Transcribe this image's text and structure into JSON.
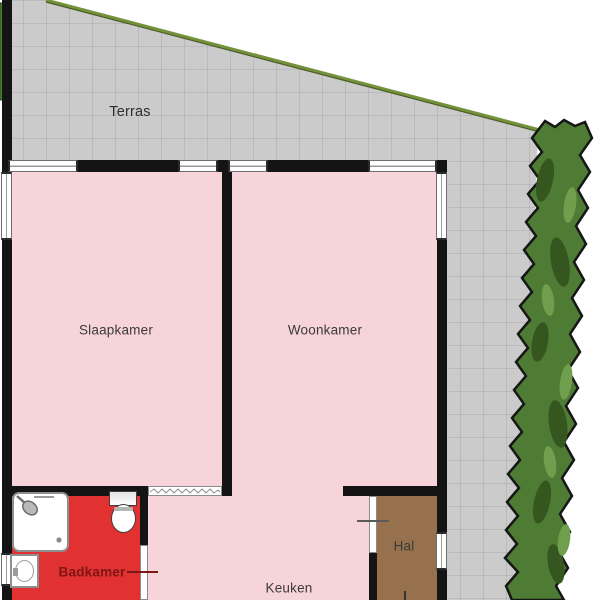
{
  "plan_type": "floorplan",
  "rooms": {
    "terras": "Terras",
    "slaapkamer": "Slaapkamer",
    "woonkamer": "Woonkamer",
    "badkamer": "Badkamer",
    "keuken": "Keuken",
    "hal": "Hal"
  },
  "fixtures": [
    "shower",
    "toilet",
    "washbasin"
  ],
  "colors": {
    "room_fill": "#f7d4da",
    "bathroom_fill": "#e23131",
    "hall_fill": "#97714d",
    "terrace_fill": "#cbcbcb",
    "hedge_green": "#4e7c34",
    "boundary_line_olive": "#74913c",
    "wall_black": "#141414",
    "label_text": "#3a3a3a",
    "bathroom_label_text": "#7e1616"
  }
}
